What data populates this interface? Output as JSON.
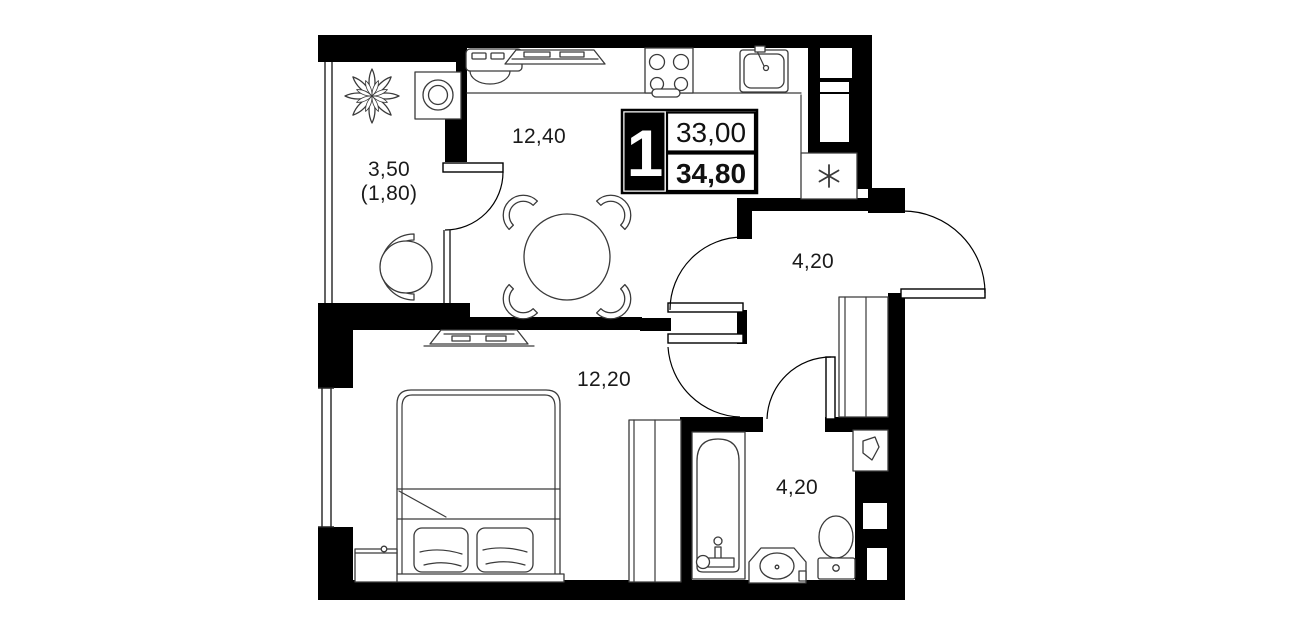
{
  "plan": {
    "title": "apartment-floor-plan",
    "info_box": {
      "rooms_count": "1",
      "area_primary": "33,00",
      "area_total": "34,80"
    },
    "rooms": {
      "balcony": {
        "area": "3,50",
        "area_secondary": "(1,80)"
      },
      "kitchen_living": {
        "area": "12,40"
      },
      "hallway": {
        "area": "4,20"
      },
      "bedroom": {
        "area": "12,20"
      },
      "bathroom": {
        "area": "4,20"
      }
    },
    "colors": {
      "walls": "#000000",
      "background": "#ffffff",
      "furniture_stroke": "#3a3a3a",
      "text": "#1a1a1a"
    },
    "furniture_icons": [
      "plant",
      "washing-machine",
      "lounge-chair",
      "kitchen-counter",
      "small-appliance",
      "cooktop-tray",
      "stove-4-burner",
      "kitchen-sink",
      "refrigerator",
      "dining-table-4-chairs",
      "tv-console",
      "double-bed",
      "pillows",
      "nightstand",
      "wardrobe",
      "hallway-closet",
      "bathtub",
      "washbasin",
      "toilet",
      "towel-cabinet"
    ]
  }
}
